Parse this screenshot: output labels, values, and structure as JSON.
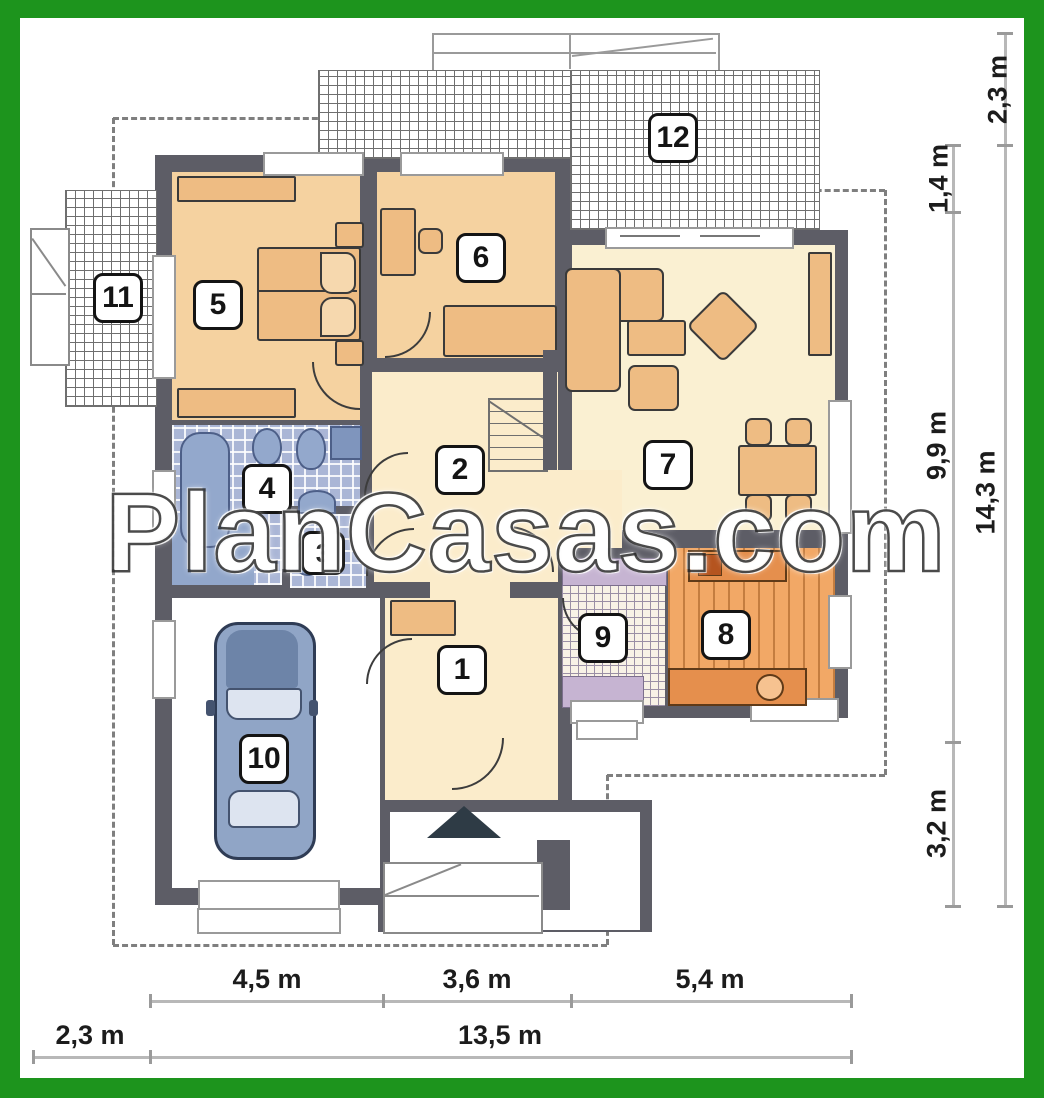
{
  "watermark": "PlanCasas.com",
  "room_labels": {
    "r1": "1",
    "r2": "2",
    "r3": "3",
    "r4": "4",
    "r5": "5",
    "r6": "6",
    "r7": "7",
    "r8": "8",
    "r9": "9",
    "r10": "10",
    "r11": "11",
    "r12": "12"
  },
  "dimensions": {
    "right_outer_top": "2,3 m",
    "right_inner_top": "1,4 m",
    "right_inner_mid": "9,9 m",
    "right_outer_main": "14,3 m",
    "right_inner_bottom": "3,2 m",
    "bottom_seg1": "4,5 m",
    "bottom_seg2": "3,6 m",
    "bottom_seg3": "5,4 m",
    "bottom_left": "2,3 m",
    "bottom_total": "13,5 m"
  },
  "colors": {
    "frame_green": "#1d941d",
    "wall_gray": "#5d5d66",
    "bedroom_floor": "#f5d2a0",
    "living_floor": "#faf0d2",
    "furniture_tan": "#eebc83",
    "kitchen_floor": "#f2a866",
    "bath_tile": "#aab6d6",
    "utility_lavender": "#c6b4d2",
    "car_body": "#90a5c6"
  }
}
